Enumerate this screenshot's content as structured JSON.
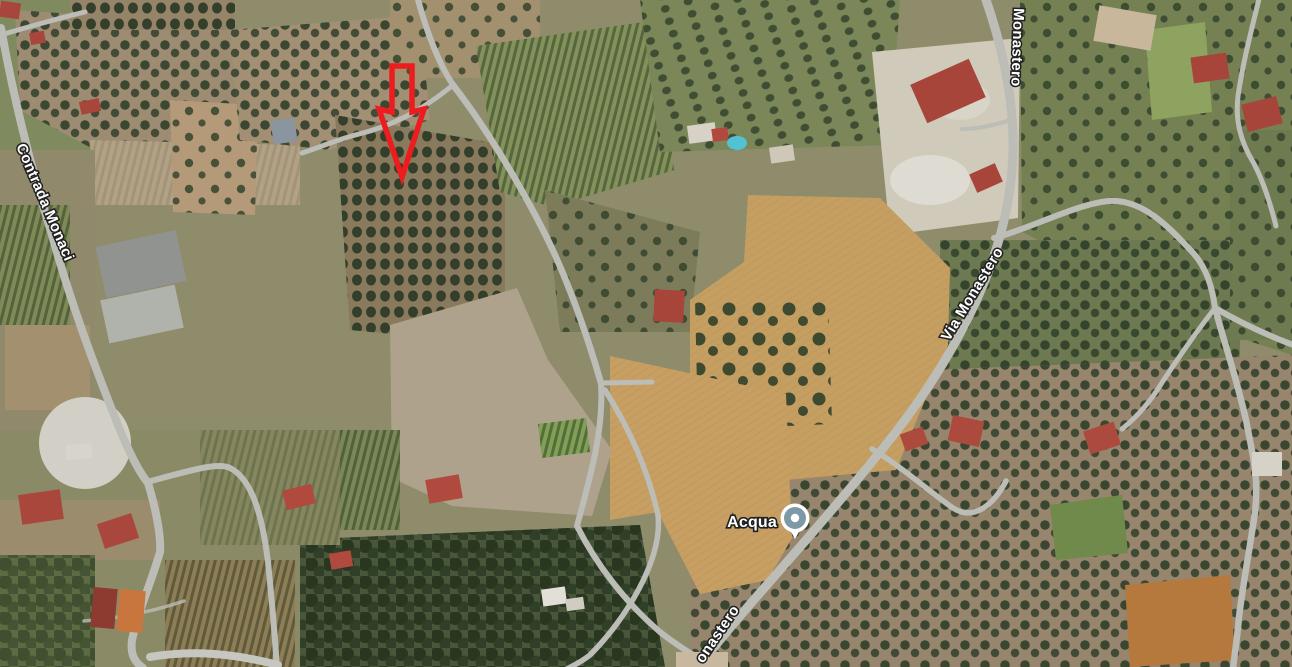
{
  "map": {
    "view": "satellite aerial view, rural olive groves, vineyards and plowed fields",
    "labels": {
      "contrada_monaci": "Contrada Monaci",
      "monastero_top": "Monastero",
      "via_monastero": "Via Monastero",
      "monastero_bottom_partial": "onastero",
      "acqua_poi": "Acqua"
    },
    "poi_marker": {
      "icon": "water-poi-pin",
      "fill": "#7d99a8",
      "ring": "#ffffff"
    },
    "annotation_arrow": {
      "icon": "red-down-arrow-outline",
      "color": "#ed1c1f"
    },
    "colors": {
      "road": "#bcbdb7",
      "label_text": "#ffffff",
      "label_halo": "#202020",
      "field_tan": "#c59e61",
      "grove_green": "#3a4a30"
    }
  }
}
